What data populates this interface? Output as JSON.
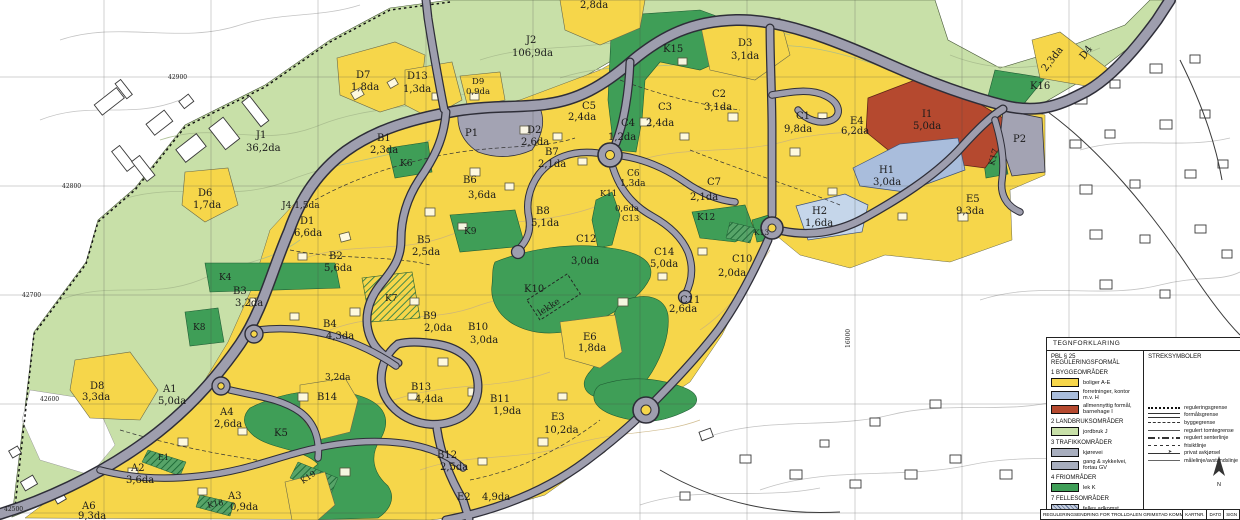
{
  "colors": {
    "yellow": "#f6d64a",
    "lightgreen": "#c8e0a8",
    "green": "#3f9e57",
    "red": "#b5492f",
    "blue": "#a9bddc",
    "blue_light": "#c5d6ea",
    "road": "#9e9eae",
    "parking": "#a3a3b3"
  },
  "map": {
    "labels": [
      {
        "t": "J1",
        "x": 256,
        "y": 138
      },
      {
        "t": "36,2da",
        "x": 246,
        "y": 151
      },
      {
        "t": "J2",
        "x": 526,
        "y": 43
      },
      {
        "t": "106,9da",
        "x": 512,
        "y": 56
      },
      {
        "t": "J4 1,5da",
        "x": 282,
        "y": 208,
        "s": 9
      },
      {
        "t": "D6",
        "x": 198,
        "y": 196
      },
      {
        "t": "1,7da",
        "x": 193,
        "y": 208
      },
      {
        "t": "D7",
        "x": 356,
        "y": 78
      },
      {
        "t": "1,8da",
        "x": 351,
        "y": 90
      },
      {
        "t": "D13",
        "x": 407,
        "y": 79
      },
      {
        "t": "1,3da",
        "x": 403,
        "y": 92
      },
      {
        "t": "D9",
        "x": 472,
        "y": 84,
        "s": 8.5
      },
      {
        "t": "0,9da",
        "x": 466,
        "y": 94,
        "s": 8.5
      },
      {
        "t": "2,8da",
        "x": 580,
        "y": 8
      },
      {
        "t": "D3",
        "x": 738,
        "y": 46
      },
      {
        "t": "3,1da",
        "x": 731,
        "y": 59
      },
      {
        "t": "D2",
        "x": 527,
        "y": 133
      },
      {
        "t": "2,6da",
        "x": 521,
        "y": 145
      },
      {
        "t": "B7",
        "x": 545,
        "y": 155
      },
      {
        "t": "2,1da",
        "x": 538,
        "y": 167
      },
      {
        "t": "B1",
        "x": 377,
        "y": 141
      },
      {
        "t": "2,3da",
        "x": 370,
        "y": 153
      },
      {
        "t": "P1",
        "x": 465,
        "y": 136
      },
      {
        "t": "K6",
        "x": 400,
        "y": 166,
        "s": 9
      },
      {
        "t": "B6",
        "x": 463,
        "y": 183
      },
      {
        "t": "3,6da",
        "x": 468,
        "y": 198
      },
      {
        "t": "B8",
        "x": 536,
        "y": 214
      },
      {
        "t": "5,1da",
        "x": 531,
        "y": 226
      },
      {
        "t": "D1",
        "x": 300,
        "y": 224
      },
      {
        "t": "6,6da",
        "x": 294,
        "y": 236
      },
      {
        "t": "B2",
        "x": 329,
        "y": 259
      },
      {
        "t": "5,6da",
        "x": 324,
        "y": 271
      },
      {
        "t": "B5",
        "x": 417,
        "y": 243
      },
      {
        "t": "2,5da",
        "x": 412,
        "y": 255
      },
      {
        "t": "K9",
        "x": 464,
        "y": 234,
        "s": 9
      },
      {
        "t": "C5",
        "x": 582,
        "y": 109
      },
      {
        "t": "2,4da",
        "x": 568,
        "y": 120
      },
      {
        "t": "C4",
        "x": 621,
        "y": 126
      },
      {
        "t": "1,2da",
        "x": 608,
        "y": 140
      },
      {
        "t": "C3",
        "x": 658,
        "y": 110
      },
      {
        "t": "2,4da",
        "x": 646,
        "y": 126
      },
      {
        "t": "C2",
        "x": 712,
        "y": 97
      },
      {
        "t": "3,1da",
        "x": 704,
        "y": 110
      },
      {
        "t": "C1",
        "x": 796,
        "y": 119
      },
      {
        "t": "9,8da",
        "x": 784,
        "y": 132
      },
      {
        "t": "E4",
        "x": 850,
        "y": 124
      },
      {
        "t": "6,2da",
        "x": 841,
        "y": 134
      },
      {
        "t": "I1",
        "x": 922,
        "y": 117
      },
      {
        "t": "5,0da",
        "x": 913,
        "y": 129
      },
      {
        "t": "H1",
        "x": 879,
        "y": 173
      },
      {
        "t": "3,0da",
        "x": 873,
        "y": 185
      },
      {
        "t": "H2",
        "x": 812,
        "y": 214
      },
      {
        "t": "1,6da",
        "x": 805,
        "y": 226
      },
      {
        "t": "E5",
        "x": 966,
        "y": 202
      },
      {
        "t": "9,3da",
        "x": 956,
        "y": 214
      },
      {
        "t": "K15",
        "x": 663,
        "y": 52
      },
      {
        "t": "K16",
        "x": 1030,
        "y": 89
      },
      {
        "t": "K17",
        "x": 994,
        "y": 166,
        "r": -75,
        "s": 8.5
      },
      {
        "t": "D4",
        "x": 1084,
        "y": 60,
        "r": -52
      },
      {
        "t": "2,3da",
        "x": 1046,
        "y": 72,
        "r": -52
      },
      {
        "t": "P2",
        "x": 1013,
        "y": 142
      },
      {
        "t": "C6",
        "x": 627,
        "y": 176,
        "s": 9
      },
      {
        "t": "1,3da",
        "x": 620,
        "y": 186,
        "s": 9
      },
      {
        "t": "K11",
        "x": 600,
        "y": 196,
        "s": 8.5
      },
      {
        "t": "0,6da",
        "x": 615,
        "y": 211,
        "s": 8.5
      },
      {
        "t": "C13",
        "x": 622,
        "y": 221,
        "s": 8.5
      },
      {
        "t": "C7",
        "x": 707,
        "y": 185
      },
      {
        "t": "2,1da",
        "x": 690,
        "y": 200
      },
      {
        "t": "K12",
        "x": 697,
        "y": 220,
        "s": 9
      },
      {
        "t": "K13",
        "x": 754,
        "y": 235,
        "s": 7.5
      },
      {
        "t": "C14",
        "x": 654,
        "y": 255
      },
      {
        "t": "5,0da",
        "x": 650,
        "y": 267
      },
      {
        "t": "C12",
        "x": 576,
        "y": 242
      },
      {
        "t": "3,0da",
        "x": 571,
        "y": 264
      },
      {
        "t": "C10",
        "x": 732,
        "y": 262
      },
      {
        "t": "2,0da",
        "x": 718,
        "y": 276
      },
      {
        "t": "C11",
        "x": 680,
        "y": 303
      },
      {
        "t": "2,6da",
        "x": 669,
        "y": 312
      },
      {
        "t": "K10",
        "x": 524,
        "y": 292
      },
      {
        "t": "lekke",
        "x": 540,
        "y": 316,
        "r": -33,
        "s": 9
      },
      {
        "t": "E6",
        "x": 583,
        "y": 340
      },
      {
        "t": "1,8da",
        "x": 578,
        "y": 351
      },
      {
        "t": "K4",
        "x": 219,
        "y": 280,
        "s": 9
      },
      {
        "t": "B3",
        "x": 233,
        "y": 294
      },
      {
        "t": "3,2da",
        "x": 235,
        "y": 306
      },
      {
        "t": "K8",
        "x": 193,
        "y": 330,
        "s": 9
      },
      {
        "t": "B4",
        "x": 323,
        "y": 327
      },
      {
        "t": "4,3da",
        "x": 326,
        "y": 339
      },
      {
        "t": "K7",
        "x": 385,
        "y": 301,
        "s": 9
      },
      {
        "t": "B9",
        "x": 423,
        "y": 319
      },
      {
        "t": "2,0da",
        "x": 424,
        "y": 331
      },
      {
        "t": "B10",
        "x": 468,
        "y": 330
      },
      {
        "t": "3,0da",
        "x": 470,
        "y": 343
      },
      {
        "t": "B13",
        "x": 411,
        "y": 390
      },
      {
        "t": "4,4da",
        "x": 415,
        "y": 402
      },
      {
        "t": "D8",
        "x": 90,
        "y": 389
      },
      {
        "t": "3,3da",
        "x": 82,
        "y": 400
      },
      {
        "t": "A1",
        "x": 163,
        "y": 392
      },
      {
        "t": "5,0da",
        "x": 158,
        "y": 404
      },
      {
        "t": "A4",
        "x": 220,
        "y": 415
      },
      {
        "t": "2,6da",
        "x": 214,
        "y": 427
      },
      {
        "t": "3,2da",
        "x": 325,
        "y": 380,
        "s": 9
      },
      {
        "t": "B14",
        "x": 317,
        "y": 400
      },
      {
        "t": "K5",
        "x": 274,
        "y": 436
      },
      {
        "t": "A2",
        "x": 131,
        "y": 471
      },
      {
        "t": "3,6da",
        "x": 126,
        "y": 483
      },
      {
        "t": "A6",
        "x": 82,
        "y": 509
      },
      {
        "t": "9,3da",
        "x": 78,
        "y": 519
      },
      {
        "t": "A3",
        "x": 228,
        "y": 499
      },
      {
        "t": "0,9da",
        "x": 230,
        "y": 510
      },
      {
        "t": "E1",
        "x": 158,
        "y": 460,
        "s": 8
      },
      {
        "t": "K19",
        "x": 303,
        "y": 484,
        "r": -35,
        "s": 8
      },
      {
        "t": "K18",
        "x": 208,
        "y": 508,
        "r": -12,
        "s": 8
      },
      {
        "t": "B11",
        "x": 490,
        "y": 402
      },
      {
        "t": "1,9da",
        "x": 493,
        "y": 414
      },
      {
        "t": "E3",
        "x": 551,
        "y": 420
      },
      {
        "t": "10,2da",
        "x": 544,
        "y": 433
      },
      {
        "t": "B12",
        "x": 437,
        "y": 458
      },
      {
        "t": "2,5da",
        "x": 440,
        "y": 470
      },
      {
        "t": "E2",
        "x": 457,
        "y": 500
      },
      {
        "t": "4,9da",
        "x": 482,
        "y": 500
      },
      {
        "t": "42900",
        "x": 168,
        "y": 79,
        "s": 6,
        "m": 1
      },
      {
        "t": "42800",
        "x": 62,
        "y": 188,
        "s": 6,
        "m": 1
      },
      {
        "t": "42700",
        "x": 22,
        "y": 297,
        "s": 6,
        "m": 1
      },
      {
        "t": "42600",
        "x": 40,
        "y": 401,
        "s": 6,
        "m": 1
      },
      {
        "t": "42500",
        "x": 4,
        "y": 511,
        "s": 6,
        "m": 1
      },
      {
        "t": "16000",
        "x": 850,
        "y": 348,
        "s": 6,
        "r": -90,
        "m": 1
      }
    ]
  },
  "legend": {
    "title": "TEGNFORKLARING",
    "left": {
      "heading": "PBL § 25 REGULERINGSFORMÅL",
      "sections": [
        {
          "name": "1 BYGGEOMRÅDER",
          "items": [
            {
              "swatch": "yellow",
              "label": "boliger A-E"
            },
            {
              "swatch": "blue",
              "label": "forretninger, kontor m.v. H"
            },
            {
              "swatch": "red",
              "label": "allmennyttig formål, barnehage I"
            }
          ]
        },
        {
          "name": "2 LANDBRUKSOMRÅDER",
          "items": [
            {
              "swatch": "lightgreen",
              "label": "jordbruk J"
            }
          ]
        },
        {
          "name": "3 TRAFIKKOMRÅDER",
          "items": [
            {
              "swatch": "gray",
              "label": "kjørevei"
            },
            {
              "swatch": "gray",
              "label": "gang & sykkelvei, fortau GV"
            }
          ]
        },
        {
          "name": "4 FRIOMRÅDER",
          "items": [
            {
              "swatch": "green",
              "label": "lek K"
            }
          ]
        },
        {
          "name": "7 FELLESOMRÅDER",
          "items": [
            {
              "swatch": "hatchgray",
              "label": "felles adkomst"
            },
            {
              "swatch": "hatchgreen",
              "label": "felles lek K"
            }
          ]
        }
      ]
    },
    "right": {
      "heading": "STREKSYMBOLER",
      "items": [
        {
          "line": "dotted",
          "label": "reguleringsgrense"
        },
        {
          "line": "double",
          "label": "formålsgrense"
        },
        {
          "line": "dash",
          "label": "byggegrense"
        },
        {
          "line": "solid",
          "label": "regulert tomtegrense"
        },
        {
          "line": "dashdot",
          "label": "regulert senterlinje"
        },
        {
          "line": "shortdash",
          "label": "frisiktlinje"
        },
        {
          "line": "arrow",
          "label": "privat avkjørsel"
        },
        {
          "line": "thin",
          "label": "målelinje/avstandslinje"
        }
      ]
    },
    "scalebar": {
      "labels": [
        "-10m",
        "0",
        "10m",
        "20m",
        "30m",
        "40m",
        "50m",
        "60m",
        "70m"
      ]
    },
    "north_label": "N"
  },
  "titleblock": {
    "title": "REGULERINGSENDRING FOR TROLLDALEN GRIMSTAD KOMMUNE",
    "fields": [
      "KARTNR.",
      "DATO",
      "SIGN"
    ]
  }
}
